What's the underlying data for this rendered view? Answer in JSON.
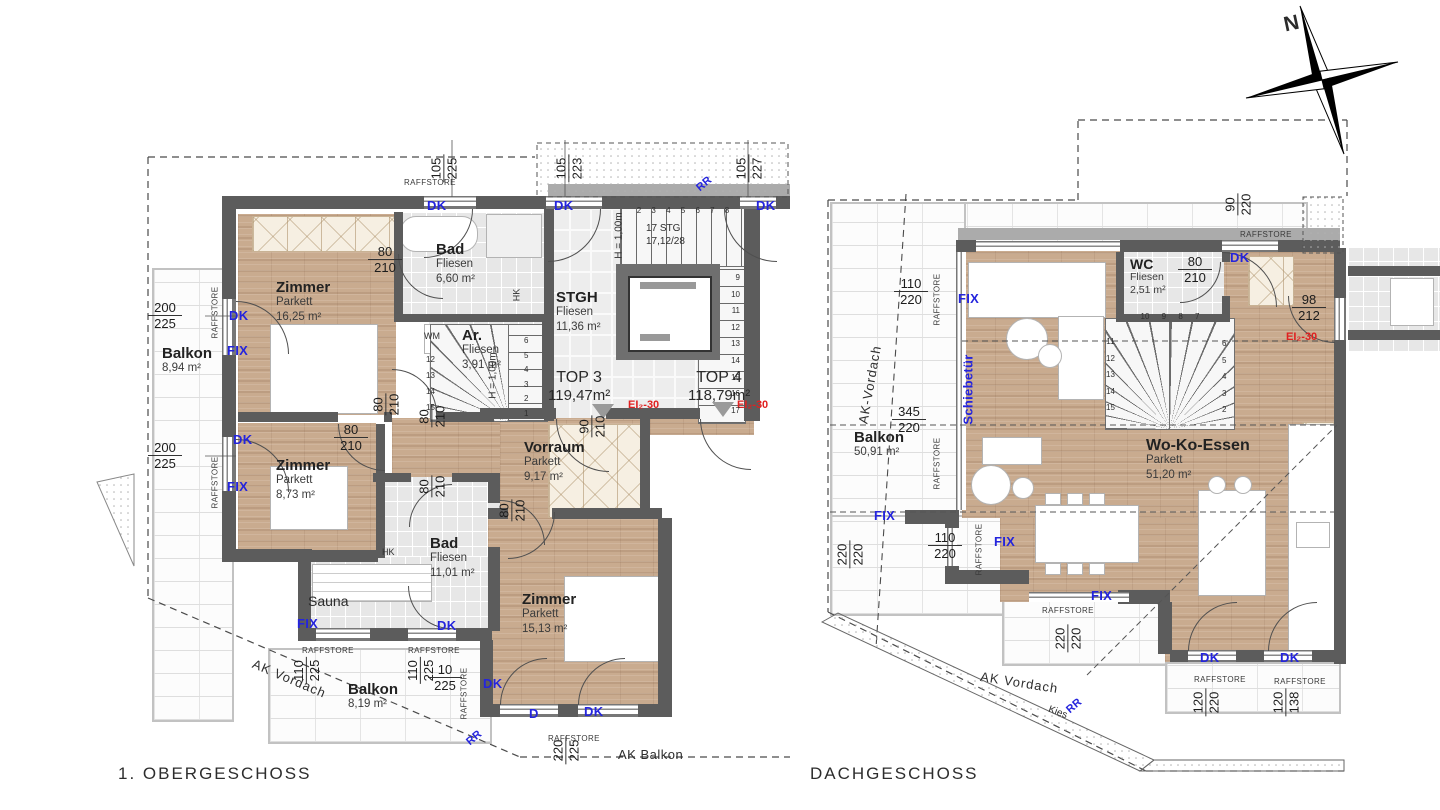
{
  "colors": {
    "wall_dark": "#5c5c5c",
    "wall_light": "#ababab",
    "parquet": "#c9ab8f",
    "tile": "#e7e7e7",
    "annotation_blue": "#2424dd",
    "fire_red": "#e02020"
  },
  "compass": {
    "north_label": "N"
  },
  "floors": {
    "og": {
      "title": "1. OBERGESCHOSS",
      "rooms": {
        "zimmer1": {
          "name": "Zimmer",
          "floor": "Parkett",
          "area": "16,25 m²"
        },
        "bad1": {
          "name": "Bad",
          "floor": "Fliesen",
          "area": "6,60 m²"
        },
        "abstellraum": {
          "name": "Ar.",
          "floor": "Fliesen",
          "area": "3,91 m²"
        },
        "stgh": {
          "name": "STGH",
          "floor": "Fliesen",
          "area": "11,36 m²"
        },
        "zimmer2": {
          "name": "Zimmer",
          "floor": "Parkett",
          "area": "8,73 m²"
        },
        "bad2": {
          "name": "Bad",
          "floor": "Fliesen",
          "area": "11,01 m²"
        },
        "sauna": {
          "name": "Sauna"
        },
        "vorraum": {
          "name": "Vorraum",
          "floor": "Parkett",
          "area": "9,17 m²"
        },
        "zimmer3": {
          "name": "Zimmer",
          "floor": "Parkett",
          "area": "15,13 m²"
        },
        "balkon_west": {
          "name": "Balkon",
          "area": "8,94 m²"
        },
        "balkon_sued": {
          "name": "Balkon",
          "area": "8,19 m²"
        }
      },
      "units": {
        "top3": {
          "label": "TOP 3",
          "area": "119,47m²",
          "fire_rating": "EI₂-30"
        },
        "top4": {
          "label": "TOP 4",
          "area": "118,79m²",
          "fire_rating": "EI₂-30"
        }
      },
      "stairs": {
        "note": "17 STG\n17,12/28",
        "height_label": "H = 1,00m",
        "top_run_numbers": "2 3 4 5 6 7 8",
        "right_run_numbers": "9\n10\n11\n12\n13\n14\n15\n16\n17",
        "spiral_left_numbers": "12\n13\n14\n15",
        "spiral_right_numbers": "6\n5\n4\n3\n2\n1"
      },
      "dims": [
        {
          "a": "105",
          "b": "225"
        },
        {
          "a": "105",
          "b": "223"
        },
        {
          "a": "105",
          "b": "227"
        },
        {
          "a": "200",
          "b": "225"
        },
        {
          "a": "200",
          "b": "225"
        },
        {
          "a": "80",
          "b": "210"
        },
        {
          "a": "80",
          "b": "210"
        },
        {
          "a": "80",
          "b": "210"
        },
        {
          "a": "80",
          "b": "210"
        },
        {
          "a": "80",
          "b": "210"
        },
        {
          "a": "80",
          "b": "210"
        },
        {
          "a": "90",
          "b": "210"
        },
        {
          "a": "110",
          "b": "225"
        },
        {
          "a": "110",
          "b": "225"
        },
        {
          "a": "10",
          "b": "225"
        },
        {
          "a": "220",
          "b": "225"
        }
      ],
      "annotations": {
        "dk": "DK",
        "fix": "FIX",
        "d": "D",
        "rr": "RR",
        "wm": "WM",
        "hk": "HK",
        "raffstore": "RAFFSTORE",
        "ak_vordach": "AK Vordach",
        "ak_balkon": "AK Balkon"
      }
    },
    "dg": {
      "title": "DACHGESCHOSS",
      "rooms": {
        "wc": {
          "name": "WC",
          "floor": "Fliesen",
          "area": "2,51 m²"
        },
        "wohn_koch_essen": {
          "name": "Wo-Ko-Essen",
          "floor": "Parkett",
          "area": "51,20 m²"
        },
        "balkon": {
          "name": "Balkon",
          "area": "50,91 m²"
        }
      },
      "fire_rating": "EI₂-30",
      "stairs": {
        "left_numbers": "11\n12\n13\n14\n15",
        "right_numbers": "6\n5\n4\n3\n2",
        "top_numbers": "10 9 8 7"
      },
      "dims": [
        {
          "a": "90",
          "b": "220"
        },
        {
          "a": "110",
          "b": "220"
        },
        {
          "a": "80",
          "b": "210"
        },
        {
          "a": "98",
          "b": "212"
        },
        {
          "a": "345",
          "b": "220"
        },
        {
          "a": "110",
          "b": "220"
        },
        {
          "a": "220",
          "b": "220"
        },
        {
          "a": "220",
          "b": "220"
        },
        {
          "a": "120",
          "b": "220"
        },
        {
          "a": "120",
          "b": "138"
        }
      ],
      "annotations": {
        "dk": "DK",
        "fix": "FIX",
        "schiebetuer": "Schiebetür",
        "rr": "RR",
        "kies": "Kies",
        "raffstore": "RAFFSTORE",
        "ak_vordach": "AK Vordach",
        "ak_vordach_diag": "AK-Vordach"
      }
    }
  }
}
